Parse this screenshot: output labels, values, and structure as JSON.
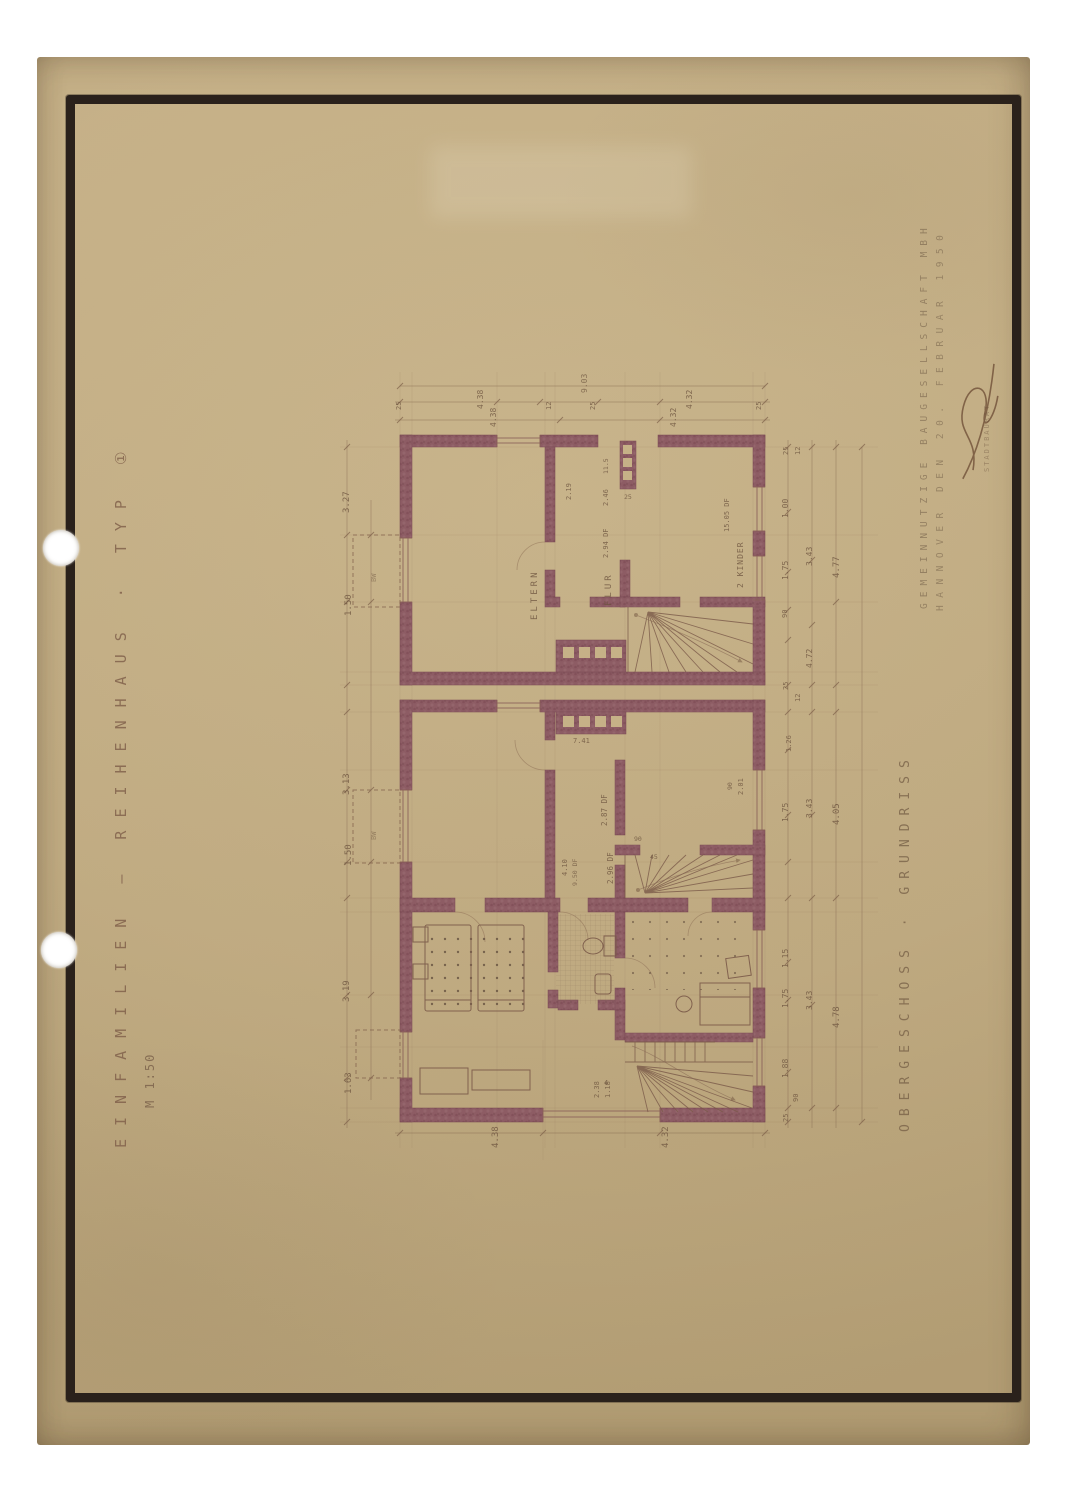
{
  "page": {
    "background": "#ffffff"
  },
  "paper": {
    "color": "#c3ad82"
  },
  "frame": {
    "color": "#2a211b"
  },
  "titles": {
    "left_title": "EINFAMILIEN – REIHENHAUS · TYP ①",
    "left_scale": "M 1:50",
    "right_company_line1": "GEMEINNÜTZIGE BAUGESELLSCHAFT MBH",
    "right_company_line2": "HANNOVER DEN 20. FEBRUAR 1950",
    "sheet_label": "OBERGESCHOSS · GRUNDRISS"
  },
  "plan": {
    "wall_color": "#8d5c64",
    "line_color": "#7b5a49",
    "dimension_color": "#6d543f",
    "annotations": [
      {
        "t": "3.27",
        "x": 343,
        "y": 513,
        "s": 9
      },
      {
        "t": "1.50",
        "x": 345,
        "y": 616,
        "s": 9
      },
      {
        "t": "3.13",
        "x": 343,
        "y": 795,
        "s": 9
      },
      {
        "t": "1.50",
        "x": 345,
        "y": 866,
        "s": 9
      },
      {
        "t": "3.19",
        "x": 343,
        "y": 1002,
        "s": 9
      },
      {
        "t": "1.63",
        "x": 345,
        "y": 1094,
        "s": 9
      },
      {
        "t": "BW",
        "x": 371,
        "y": 582,
        "s": 7,
        "o": 0.5
      },
      {
        "t": "BW",
        "x": 371,
        "y": 840,
        "s": 7,
        "o": 0.5
      },
      {
        "t": "9.03",
        "x": 581,
        "y": 393,
        "s": 8,
        "o": 0.7
      },
      {
        "t": "25",
        "x": 396,
        "y": 410,
        "s": 7
      },
      {
        "t": "4.38",
        "x": 477,
        "y": 409,
        "s": 8
      },
      {
        "t": "12",
        "x": 546,
        "y": 410,
        "s": 7
      },
      {
        "t": "25",
        "x": 590,
        "y": 410,
        "s": 7
      },
      {
        "t": "4.32",
        "x": 686,
        "y": 409,
        "s": 8
      },
      {
        "t": "25",
        "x": 756,
        "y": 410,
        "s": 7
      },
      {
        "t": "4.38",
        "x": 490,
        "y": 427,
        "s": 8
      },
      {
        "t": "4.32",
        "x": 670,
        "y": 427,
        "s": 8
      },
      {
        "t": "25",
        "x": 783,
        "y": 455,
        "s": 7
      },
      {
        "t": "12",
        "x": 795,
        "y": 455,
        "s": 7
      },
      {
        "t": "1.00",
        "x": 782,
        "y": 518,
        "s": 8
      },
      {
        "t": "1.75",
        "x": 782,
        "y": 580,
        "s": 8
      },
      {
        "t": "90",
        "x": 782,
        "y": 618,
        "s": 7
      },
      {
        "t": "3.43",
        "x": 806,
        "y": 566,
        "s": 8
      },
      {
        "t": "4.77",
        "x": 833,
        "y": 578,
        "s": 9
      },
      {
        "t": "4.72",
        "x": 806,
        "y": 668,
        "s": 8
      },
      {
        "t": "25",
        "x": 783,
        "y": 690,
        "s": 7
      },
      {
        "t": "12",
        "x": 795,
        "y": 702,
        "s": 7
      },
      {
        "t": "1.26",
        "x": 786,
        "y": 752,
        "s": 7
      },
      {
        "t": "1.75",
        "x": 782,
        "y": 822,
        "s": 8
      },
      {
        "t": "3.43",
        "x": 806,
        "y": 818,
        "s": 8
      },
      {
        "t": "4.05",
        "x": 833,
        "y": 825,
        "s": 9
      },
      {
        "t": "1.15",
        "x": 782,
        "y": 968,
        "s": 8
      },
      {
        "t": "1.75",
        "x": 782,
        "y": 1008,
        "s": 8
      },
      {
        "t": "3.43",
        "x": 806,
        "y": 1010,
        "s": 8
      },
      {
        "t": "4.78",
        "x": 833,
        "y": 1028,
        "s": 9
      },
      {
        "t": "1.88",
        "x": 782,
        "y": 1078,
        "s": 8
      },
      {
        "t": "90",
        "x": 793,
        "y": 1102,
        "s": 7
      },
      {
        "t": "25",
        "x": 783,
        "y": 1122,
        "s": 7
      },
      {
        "t": "4.38",
        "x": 492,
        "y": 1148,
        "s": 9
      },
      {
        "t": "4.32",
        "x": 662,
        "y": 1148,
        "s": 9
      },
      {
        "t": "2.38",
        "x": 594,
        "y": 1098,
        "s": 7
      },
      {
        "t": "1.18",
        "x": 605,
        "y": 1098,
        "s": 7
      },
      {
        "t": "ELTERN",
        "x": 531,
        "y": 620,
        "s": 9,
        "ls": 3,
        "n": "room-label-eltern"
      },
      {
        "t": "FLUR",
        "x": 605,
        "y": 606,
        "s": 9,
        "ls": 3,
        "n": "room-label-flur"
      },
      {
        "t": "2 KINDER",
        "x": 737,
        "y": 588,
        "s": 8,
        "ls": 1,
        "n": "room-label-kinder"
      },
      {
        "t": "15.05 DF",
        "x": 724,
        "y": 532,
        "s": 7
      },
      {
        "t": "2.19",
        "x": 566,
        "y": 500,
        "s": 7
      },
      {
        "t": "11.5",
        "x": 603,
        "y": 474,
        "s": 6.5
      },
      {
        "t": "2.46",
        "x": 603,
        "y": 506,
        "s": 7
      },
      {
        "t": "2.94 DF",
        "x": 603,
        "y": 558,
        "s": 7
      },
      {
        "t": "25",
        "x": 624,
        "y": 494,
        "s": 6.5,
        "r": 0
      },
      {
        "t": "7.41",
        "x": 573,
        "y": 738,
        "s": 7,
        "r": 0
      },
      {
        "t": "2.87 DF",
        "x": 601,
        "y": 826,
        "s": 7.5
      },
      {
        "t": "2.96 DF",
        "x": 607,
        "y": 884,
        "s": 7.5
      },
      {
        "t": "4.10",
        "x": 562,
        "y": 876,
        "s": 7
      },
      {
        "t": "9.50 DF",
        "x": 572,
        "y": 886,
        "s": 6.5,
        "o": 0.7
      },
      {
        "t": "90",
        "x": 634,
        "y": 836,
        "s": 6.5,
        "r": 0
      },
      {
        "t": "45",
        "x": 650,
        "y": 854,
        "s": 6.5,
        "r": 0
      },
      {
        "t": "90",
        "x": 727,
        "y": 790,
        "s": 6.5
      },
      {
        "t": "2.01",
        "x": 738,
        "y": 795,
        "s": 7
      },
      {
        "t": "4",
        "x": 604,
        "y": 1080,
        "s": 7,
        "r": 0
      },
      {
        "t": "STADTBAURAT",
        "x": 984,
        "y": 472,
        "s": 7,
        "o": 0.45,
        "ls": 2,
        "n": "stamp-small-text"
      }
    ]
  }
}
